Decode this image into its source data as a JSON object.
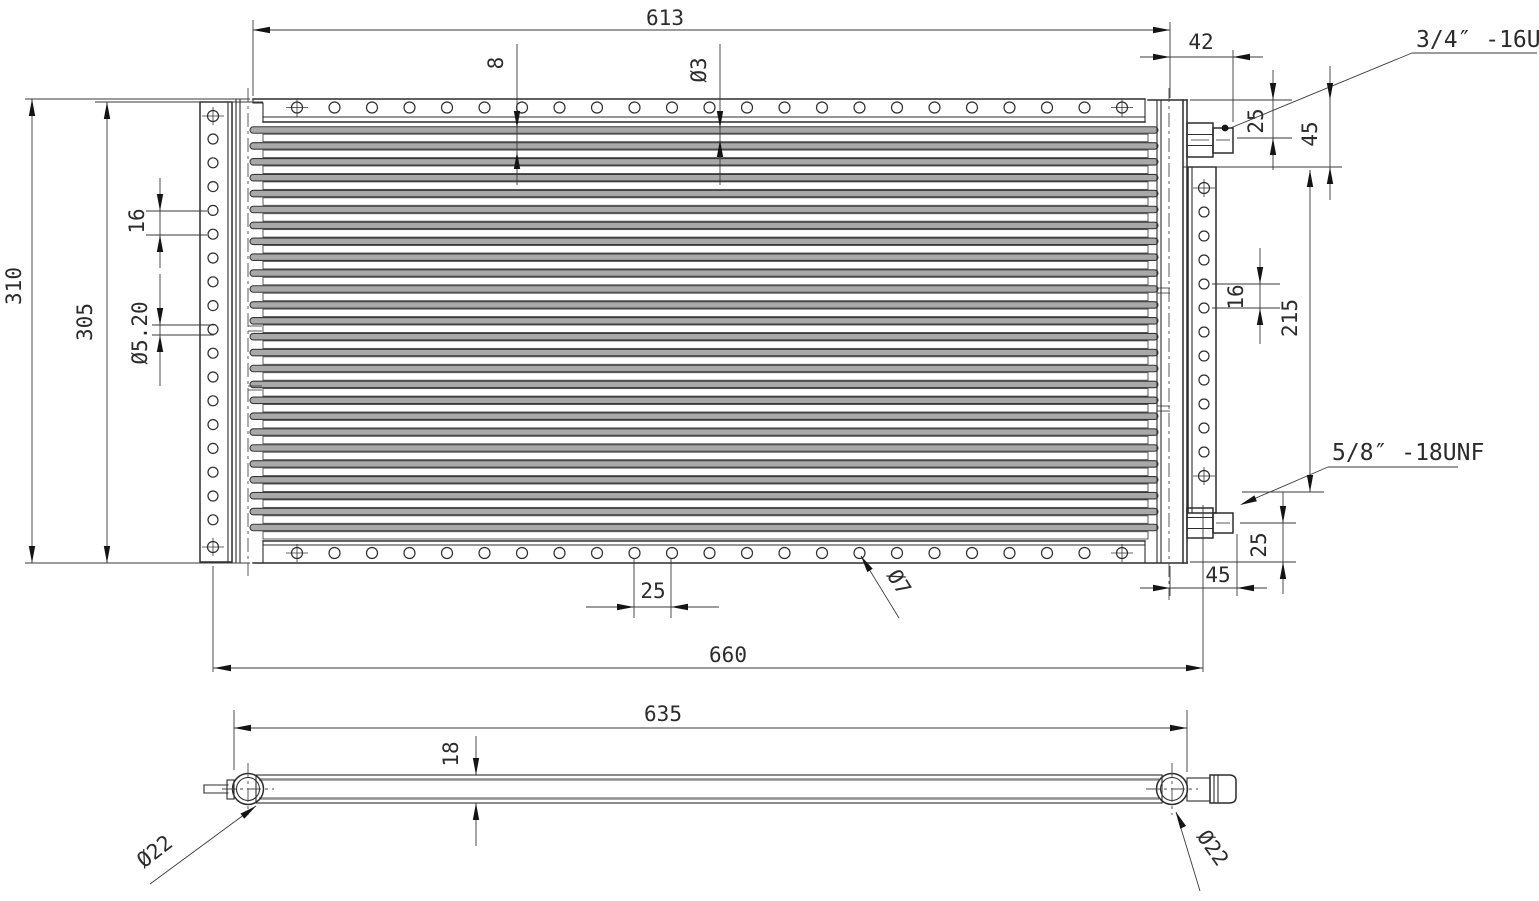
{
  "front_view": {
    "dimensions": {
      "core_width": "613",
      "fitting_overhang": "42",
      "top_fitting_offset": "25",
      "top_plate_offset": "45",
      "edge_hole_offset": "8",
      "vent_hole_dia": "Ø3",
      "overall_height": "310",
      "side_plate_height": "305",
      "left_hole_pitch": "16",
      "left_hole_dia": "Ø5.20",
      "right_hole_pitch": "16",
      "right_plate_span": "215",
      "bottom_fitting_offset": "25",
      "bottom_fitting_overhang": "45",
      "mount_hole_pitch": "25",
      "mount_hole_dia": "Ø7",
      "overall_width": "660"
    },
    "callouts": {
      "top_fitting_thread": "3/4″ -16UNF",
      "bottom_fitting_thread": "5/8″ -18UNF"
    }
  },
  "bottom_view": {
    "dimensions": {
      "tube_length": "635",
      "core_thickness": "18",
      "left_tube_dia": "Ø22",
      "right_tube_dia": "Ø22"
    }
  }
}
